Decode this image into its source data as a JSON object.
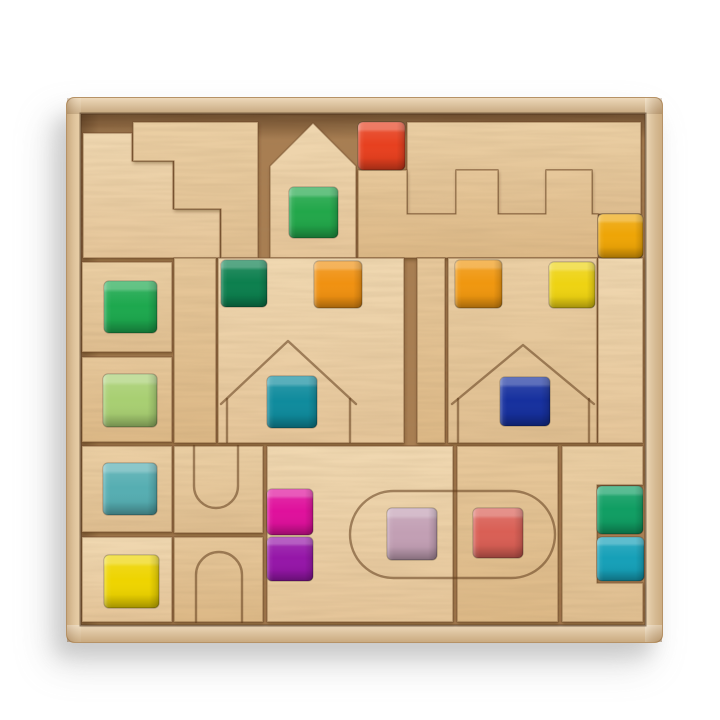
{
  "scene": {
    "description": "Top-down product photo of a natural beech wooden building-block set arranged inside a square wooden tray. Blocks include interlocking staircase puzzle pieces, a house-shaped block, two interlocking castle crenellated wall pieces, tall planks with house engravings, arch and U-groove blocks, a two-part stadium-engraved block pair, and a notched corner block. Translucent acrylic gem cubes are set into notches and engravings.",
    "background": "#ffffff",
    "shadow": "#9a9a9a",
    "tray": {
      "wood": "#e6c99e",
      "floor": "#a87e52",
      "inner_lip": "#3e2612"
    },
    "wood_tones": {
      "light": "#f0d8b1",
      "mid": "#ebcfa4",
      "warm": "#e7c89b"
    },
    "counts": {
      "wooden_blocks": 19,
      "gem_cubes": 19
    }
  },
  "gems": {
    "green_house": {
      "label": "green gem cube in house block",
      "color": "#22a74a"
    },
    "red": {
      "label": "red gem cube on castle wall",
      "color": "#e7401f"
    },
    "amber": {
      "label": "amber gem cube",
      "color": "#eea506"
    },
    "green_sq": {
      "label": "green gem cube",
      "color": "#1da84e"
    },
    "emerald": {
      "label": "dark emerald gem cube",
      "color": "#0c7f4e"
    },
    "orange_a": {
      "label": "orange gem cube",
      "color": "#f09111"
    },
    "orange_b": {
      "label": "orange gem cube",
      "color": "#f0970f"
    },
    "yellow_a": {
      "label": "yellow gem cube",
      "color": "#eed312"
    },
    "lightgreen": {
      "label": "light green gem cube",
      "color": "#a8cf72"
    },
    "teal_house": {
      "label": "teal gem cube in house engraving",
      "color": "#0f8b9d"
    },
    "blue_house": {
      "label": "royal blue gem cube in house engraving",
      "color": "#16309e"
    },
    "teal_sq": {
      "label": "soft teal gem cube",
      "color": "#56aeb2"
    },
    "magenta": {
      "label": "magenta gem cube",
      "color": "#df109c"
    },
    "mauve": {
      "label": "mauve gem cube in stadium engraving",
      "color": "#c29fb4"
    },
    "coral": {
      "label": "coral gem cube in stadium engraving",
      "color": "#d95f55"
    },
    "green_r": {
      "label": "green gem cube right column",
      "color": "#109e63"
    },
    "yellow_b": {
      "label": "yellow gem cube",
      "color": "#eed400"
    },
    "purple": {
      "label": "purple gem cube",
      "color": "#9516a8"
    },
    "teal_r": {
      "label": "teal gem cube right column",
      "color": "#16a0b8"
    }
  }
}
